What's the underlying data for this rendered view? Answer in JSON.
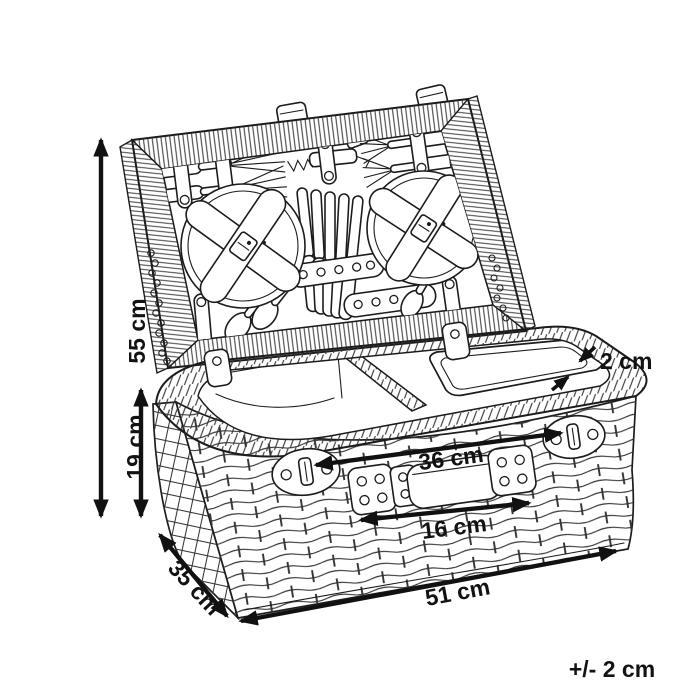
{
  "diagram": {
    "labels": {
      "height_total": "55 cm",
      "basket_height": "19 cm",
      "rim_thickness": "2 cm",
      "strap_distance": "36 cm",
      "handle_width": "16 cm",
      "depth": "35 cm",
      "width": "51 cm",
      "tolerance": "+/- 2 cm"
    },
    "colors": {
      "line": "#1c1c1c",
      "label": "#121212",
      "background": "#ffffff"
    }
  }
}
